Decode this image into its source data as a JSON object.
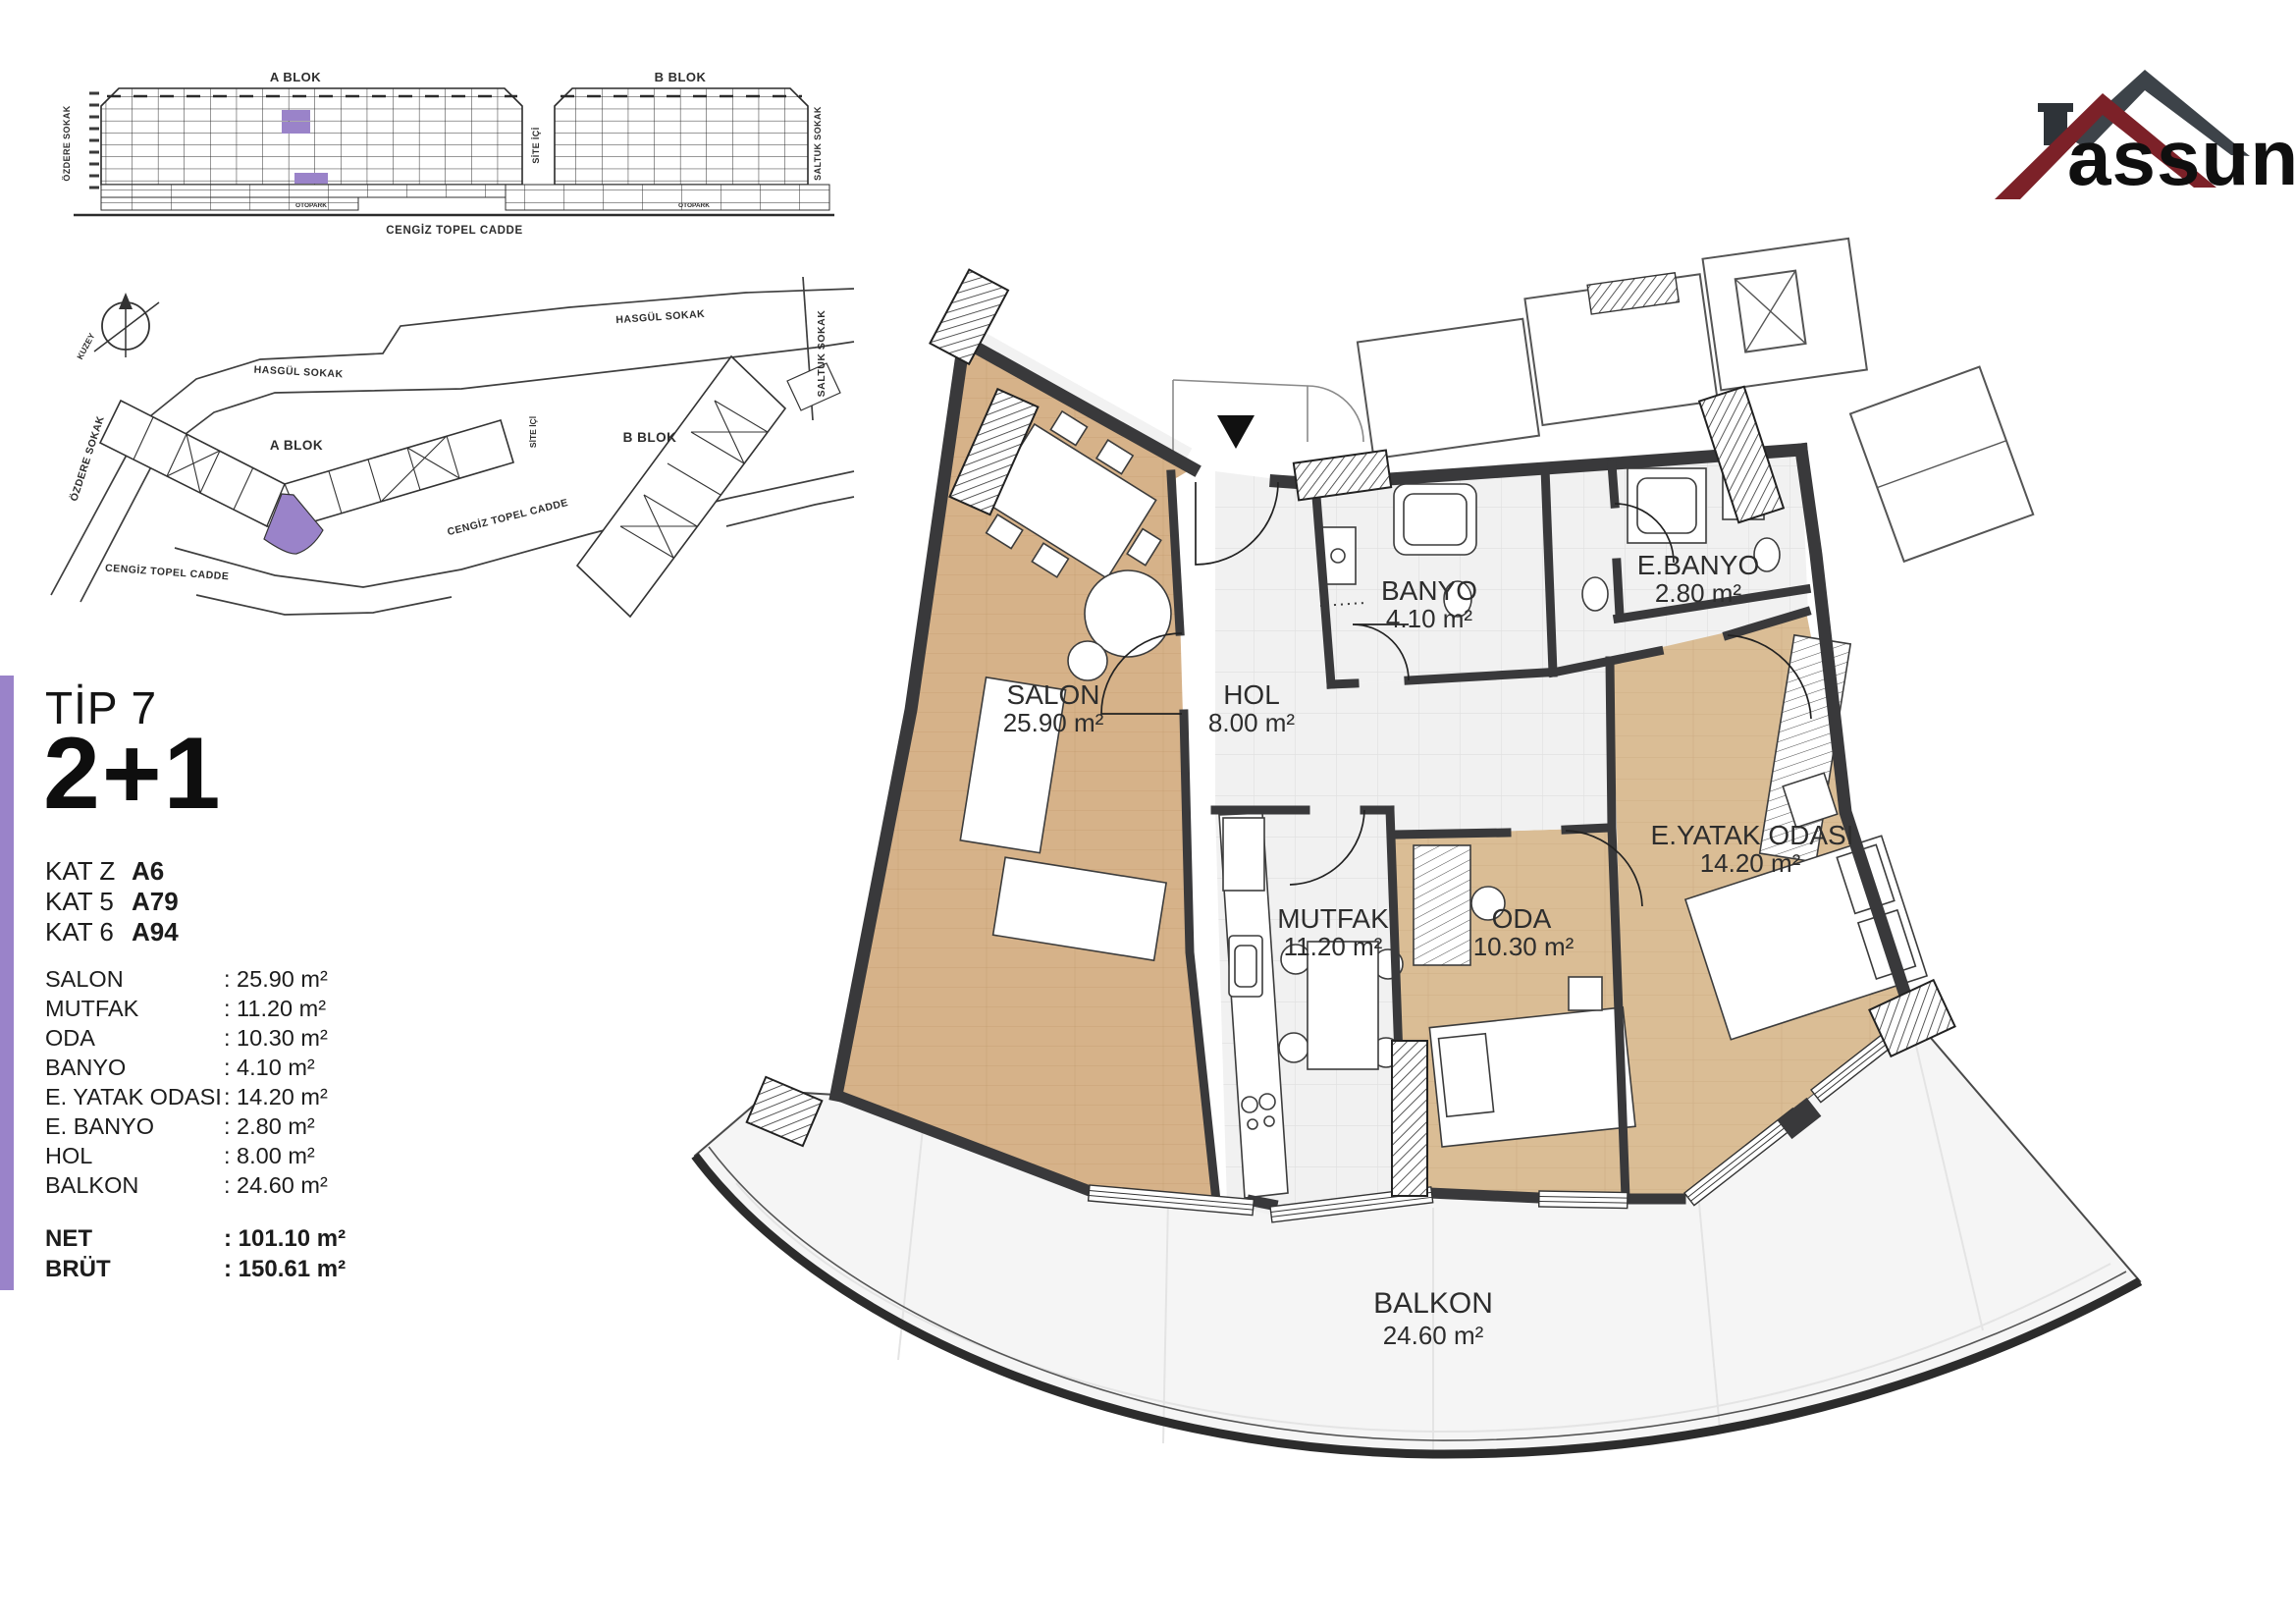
{
  "accent_color": "#9a83c9",
  "wall_color": "#39393b",
  "wood_color": "#d6b289",
  "logo": {
    "brand": "assun",
    "roof_red": "#7c2128",
    "roof_gray": "#3d4349"
  },
  "elevation": {
    "a_blok": "A BLOK",
    "b_blok": "B BLOK",
    "street_left": "ÖZDERE SOKAK",
    "street_mid": "SİTE İÇİ",
    "street_right": "SALTUK SOKAK",
    "street_bottom": "CENGİZ TOPEL CADDE",
    "otopark_a": "OTOPARK",
    "otopark_b": "OTOPARK"
  },
  "site_map": {
    "compass": "KUZEY",
    "hasgul_1": "HASGÜL SOKAK",
    "hasgul_2": "HASGÜL SOKAK",
    "ozdere": "ÖZDERE SOKAK",
    "saltuk": "SALTUK SOKAK",
    "site_ici": "SİTE İÇİ",
    "cengiz_1": "CENGİZ TOPEL CADDE",
    "cengiz_2": "CENGİZ TOPEL CADDE",
    "a_blok": "A BLOK",
    "b_blok": "B BLOK"
  },
  "panel": {
    "type_label": "TİP 7",
    "layout": "2+1",
    "floors": [
      {
        "label": "KAT Z",
        "unit": "A6"
      },
      {
        "label": "KAT 5",
        "unit": "A79"
      },
      {
        "label": "KAT 6",
        "unit": "A94"
      }
    ],
    "rooms": [
      {
        "name": "SALON",
        "value": ": 25.90 m²"
      },
      {
        "name": "MUTFAK",
        "value": ": 11.20 m²"
      },
      {
        "name": "ODA",
        "value": ": 10.30 m²"
      },
      {
        "name": "BANYO",
        "value": ": 4.10 m²"
      },
      {
        "name": "E. YATAK ODASI",
        "value": ": 14.20 m²"
      },
      {
        "name": "E. BANYO",
        "value": ": 2.80 m²"
      },
      {
        "name": "HOL",
        "value": ": 8.00 m²"
      },
      {
        "name": "BALKON",
        "value": ": 24.60 m²"
      }
    ],
    "totals": [
      {
        "label": "NET",
        "value": ": 101.10 m²"
      },
      {
        "label": "BRÜT",
        "value": ": 150.61 m²"
      }
    ]
  },
  "floor_plan": {
    "rooms": [
      {
        "name": "SALON",
        "area": "25.90 m²"
      },
      {
        "name": "HOL",
        "area": "8.00 m²"
      },
      {
        "name": "BANYO",
        "area": "4.10 m²"
      },
      {
        "name": "E.BANYO",
        "area": "2.80 m²"
      },
      {
        "name": "E.YATAK ODASI",
        "area": "14.20 m²"
      },
      {
        "name": "MUTFAK",
        "area": "11.20 m²"
      },
      {
        "name": "ODA",
        "area": "10.30 m²"
      },
      {
        "name": "BALKON",
        "area": "24.60 m²"
      }
    ]
  }
}
